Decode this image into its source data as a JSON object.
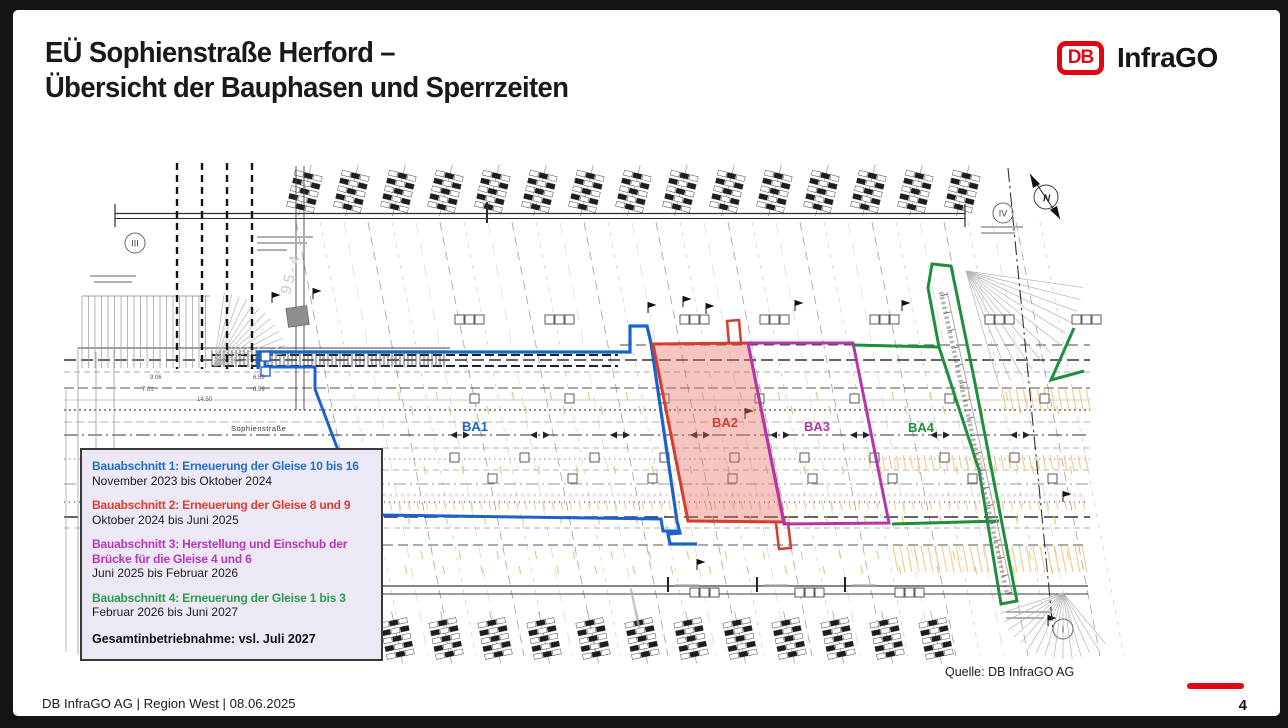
{
  "slide": {
    "title_line1": "EÜ Sophienstraße Herford –",
    "title_line2": "Übersicht der Bauphasen und Sperrzeiten",
    "logo": {
      "db": "DB",
      "brand": "InfraGO"
    },
    "source_note": "Quelle: DB InfraGO AG",
    "footer_left": "DB InfraGO AG | Region West | 08.06.2025",
    "page_number": "4"
  },
  "legend": {
    "items": [
      {
        "title": "Bauabschnitt 1: Erneuerung der Gleise 10 bis 16",
        "period": "November 2023 bis Oktober 2024",
        "color": "#1E6FD0"
      },
      {
        "title": "Bauabschnitt 2: Erneuerung der Gleise 8 und 9",
        "period": "Oktober 2024 bis Juni 2025",
        "color": "#E23B2E"
      },
      {
        "title": "Bauabschnitt 3: Herstellung und Einschub der Brücke für die Gleise 4 und 6",
        "period": "Juni 2025 bis Februar 2026",
        "color": "#BB35BB"
      },
      {
        "title": "Bauabschnitt 4: Erneuerung der Gleise 1 bis 3",
        "period": "Februar 2026 bis Juni 2027",
        "color": "#2D9E49"
      }
    ],
    "summary": "Gesamtinbetriebnahme: vsl. Juli 2027"
  },
  "plan": {
    "phase_labels": {
      "ba1": "BA1",
      "ba2": "BA2",
      "ba3": "BA3",
      "ba4": "BA4"
    },
    "street_label": "Sophienstraße",
    "compass_n": "N",
    "section_markers": {
      "left": "III",
      "top_right": "IV",
      "bottom_right": "I"
    },
    "chainage_label": "95-4",
    "dimensions": [
      "9.06",
      "6.59",
      "7.01",
      "14.50"
    ],
    "colors": {
      "ba1": "#1A63CC",
      "ba2": "#D23F31",
      "ba2_fill": "rgba(236,110,100,0.40)",
      "ba3": "#B535AD",
      "ba4": "#1F8F3C"
    }
  }
}
